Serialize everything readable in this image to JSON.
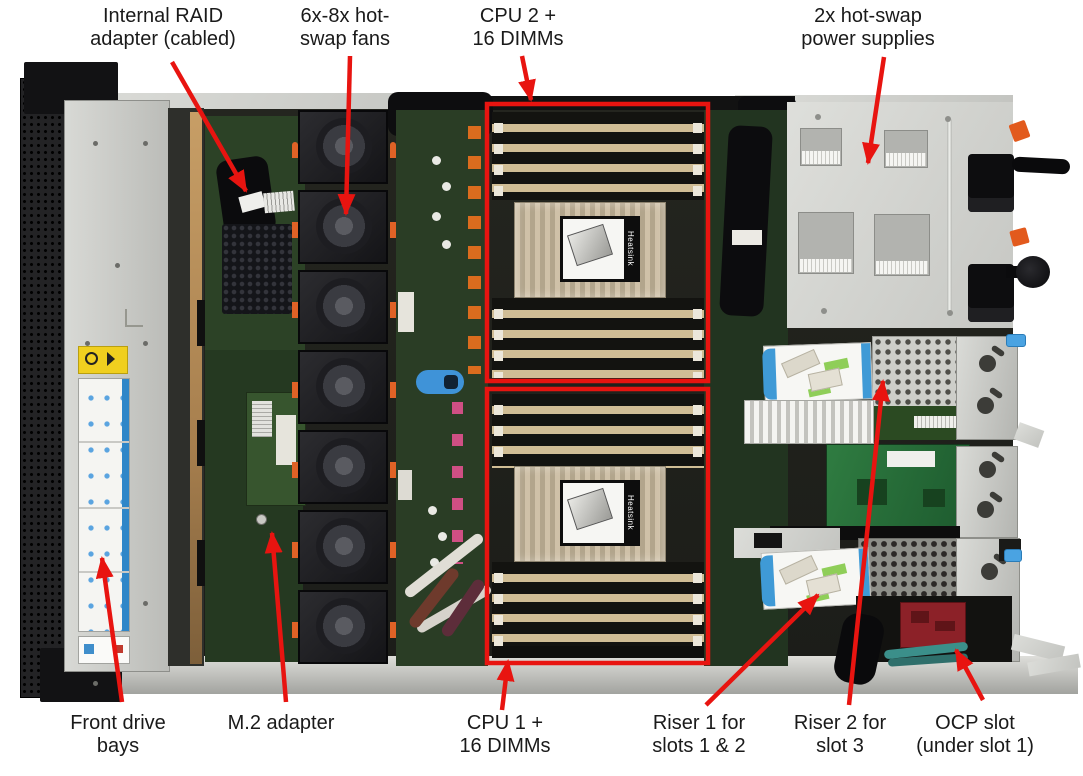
{
  "figure": {
    "type": "annotated-hardware-photo",
    "subject": "Server internal top view with component callouts",
    "background": "#ffffff",
    "annotation_color": "#e81410",
    "text_color": "#1a1a1a"
  },
  "photo": {
    "heatsink_label": "Heatsink",
    "colors": {
      "chassis_metal": "#c9cac6",
      "interior": "#20211d",
      "pcb_green": "#2a3d25",
      "dimm_tan": "#d0bd95",
      "fan_black": "#1a1a1e",
      "orange_clip": "#e06226",
      "blue_touchpoint": "#3f93d8",
      "ocp_red": "#8c2128"
    }
  },
  "highlight_boxes": [
    {
      "id": "cpu2-dimms",
      "x": 487,
      "y": 104,
      "w": 221,
      "h": 277
    },
    {
      "id": "cpu1-dimms",
      "x": 487,
      "y": 389,
      "w": 221,
      "h": 274
    }
  ],
  "callouts": {
    "top": [
      {
        "id": "internal-raid-adapter",
        "lines": [
          "Internal RAID",
          "adapter (cabled)"
        ],
        "cx": 163,
        "arrow": {
          "x1": 172,
          "y1": 62,
          "x2": 246,
          "y2": 191
        }
      },
      {
        "id": "hot-swap-fans",
        "lines": [
          "6x-8x hot-",
          "swap fans"
        ],
        "cx": 345,
        "arrow": {
          "x1": 350,
          "y1": 56,
          "x2": 346,
          "y2": 214
        }
      },
      {
        "id": "cpu2-16-dimms",
        "lines": [
          "CPU 2 +",
          "16 DIMMs"
        ],
        "cx": 518,
        "arrow": {
          "x1": 522,
          "y1": 56,
          "x2": 531,
          "y2": 100
        }
      },
      {
        "id": "power-supplies",
        "lines": [
          "2x hot-swap",
          "power supplies"
        ],
        "cx": 868,
        "arrow": {
          "x1": 884,
          "y1": 57,
          "x2": 868,
          "y2": 163
        }
      }
    ],
    "bottom": [
      {
        "id": "front-drive-bays",
        "lines": [
          "Front drive",
          "bays"
        ],
        "cx": 118,
        "arrow": {
          "x1": 122,
          "y1": 702,
          "x2": 102,
          "y2": 558
        }
      },
      {
        "id": "m2-adapter",
        "lines": [
          "M.2 adapter"
        ],
        "cx": 281,
        "arrow": {
          "x1": 286,
          "y1": 702,
          "x2": 272,
          "y2": 533
        }
      },
      {
        "id": "cpu1-16-dimms",
        "lines": [
          "CPU 1 +",
          "16 DIMMs"
        ],
        "cx": 505,
        "arrow": {
          "x1": 502,
          "y1": 710,
          "x2": 508,
          "y2": 661
        }
      },
      {
        "id": "riser1",
        "lines": [
          "Riser 1 for",
          "slots 1 & 2"
        ],
        "cx": 699,
        "arrow": {
          "x1": 706,
          "y1": 705,
          "x2": 818,
          "y2": 595
        }
      },
      {
        "id": "riser2",
        "lines": [
          "Riser 2 for",
          "slot 3"
        ],
        "cx": 840,
        "arrow": {
          "x1": 849,
          "y1": 705,
          "x2": 883,
          "y2": 381
        }
      },
      {
        "id": "ocp-slot",
        "lines": [
          "OCP slot",
          "(under slot 1)"
        ],
        "cx": 975,
        "arrow": {
          "x1": 983,
          "y1": 700,
          "x2": 956,
          "y2": 650
        }
      }
    ]
  }
}
